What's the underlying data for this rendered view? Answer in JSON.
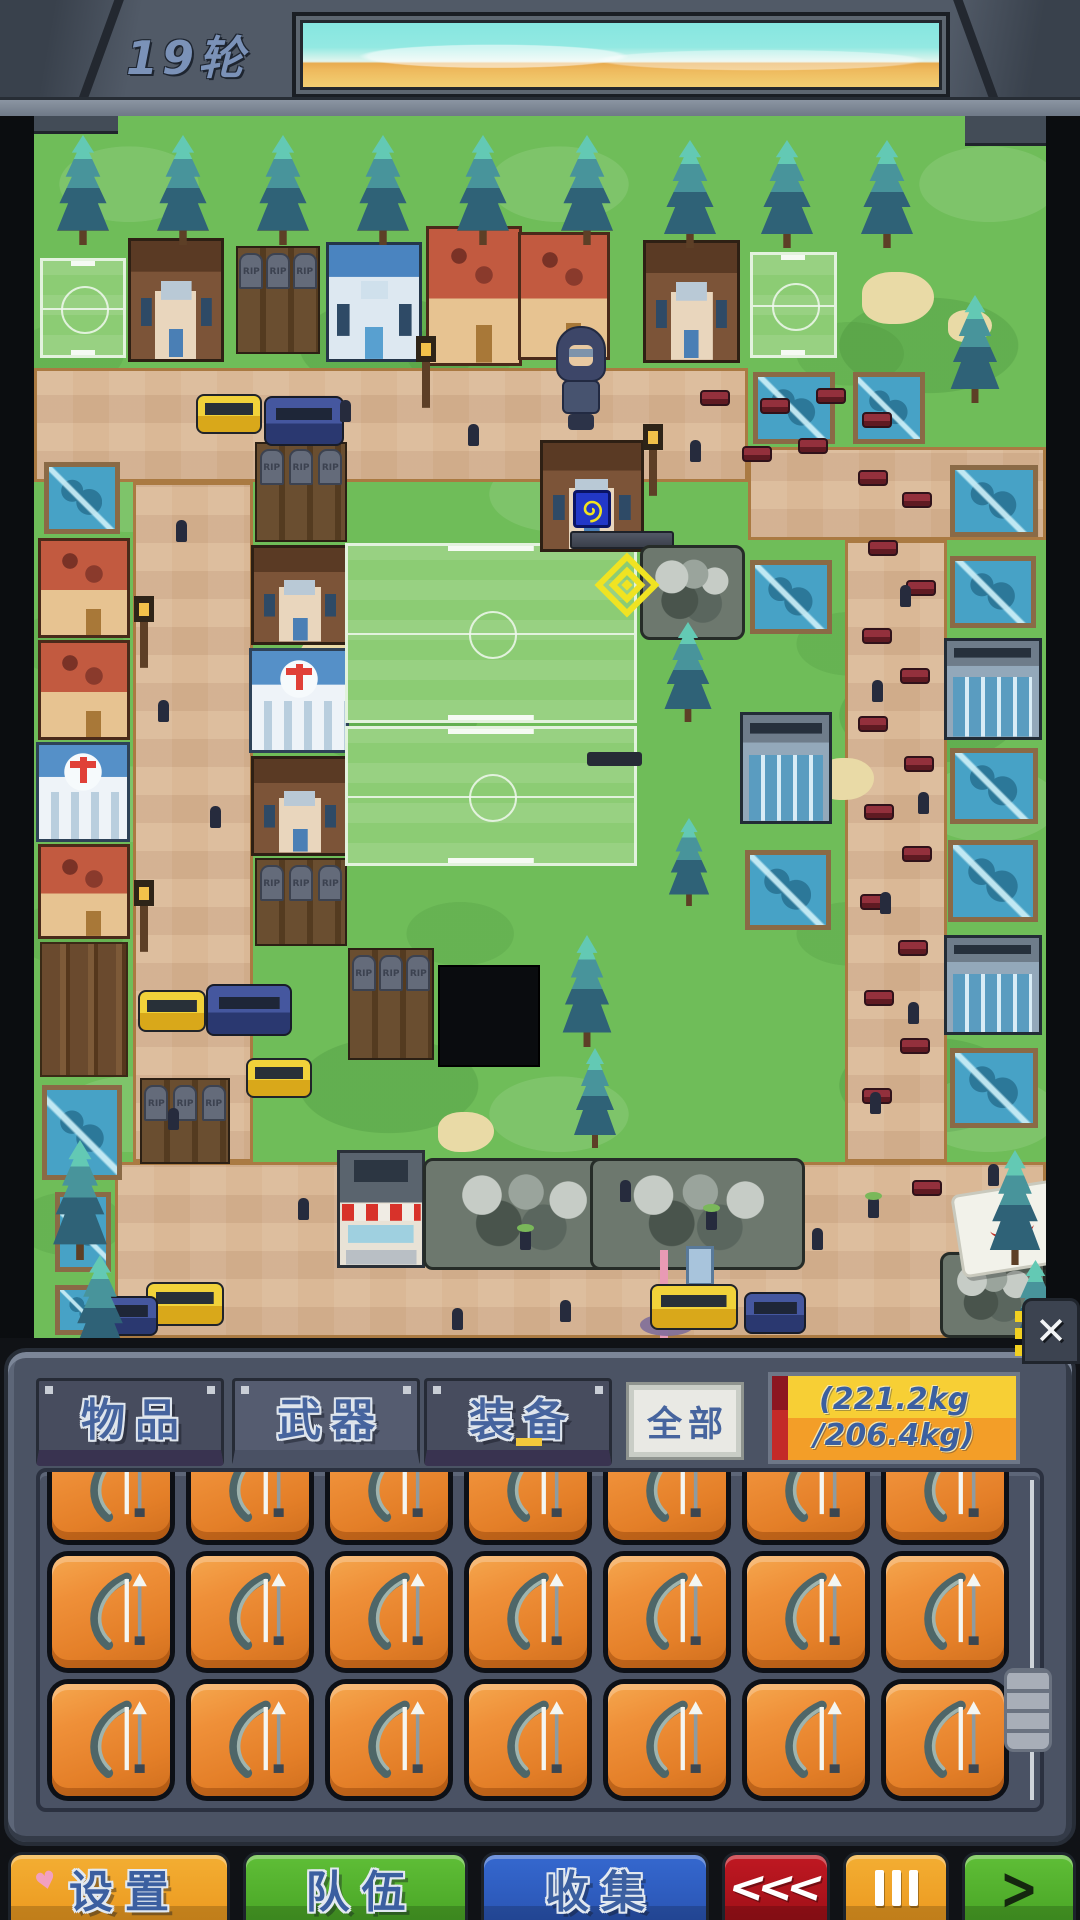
{
  "hud": {
    "round_label": "19轮"
  },
  "inventory_panel": {
    "tabs": [
      {
        "label": "物品",
        "active": false
      },
      {
        "label": "武器",
        "active": true
      },
      {
        "label": "装备",
        "active": false
      }
    ],
    "filter_all_label": "全部",
    "weight": {
      "line1": "(221.2kg",
      "line2": "/206.4kg)",
      "current_kg": 221.2,
      "capacity_kg": 206.4,
      "over_capacity": true
    },
    "close_glyph": "✕",
    "grid": {
      "rows": 3,
      "cols": 7,
      "visible_items": 21,
      "item": {
        "name": "bow",
        "icon": "bow-icon",
        "tile_color": "#e8852e"
      }
    }
  },
  "bottom_bar": {
    "settings_label": "设置",
    "settings_heart": "♥",
    "team_label": "队伍",
    "collect_label": "收集",
    "rewind_glyph": "<<<",
    "pause_icon": "three-vertical-bars",
    "forward_glyph": ">"
  },
  "map": {
    "tombstone_label": "RIP"
  },
  "colors": {
    "accent_yellow": "#f2e31f",
    "weight_warning_red": "#c32a28",
    "panel_gray": "#4b5364",
    "grass_green": "#6fbd59",
    "road_tan": "#dab896",
    "pool_blue": "#47a2c6",
    "button_orange": "#f0a22c",
    "button_green": "#55b532",
    "button_blue": "#2e61c8",
    "button_red": "#b2121e"
  }
}
